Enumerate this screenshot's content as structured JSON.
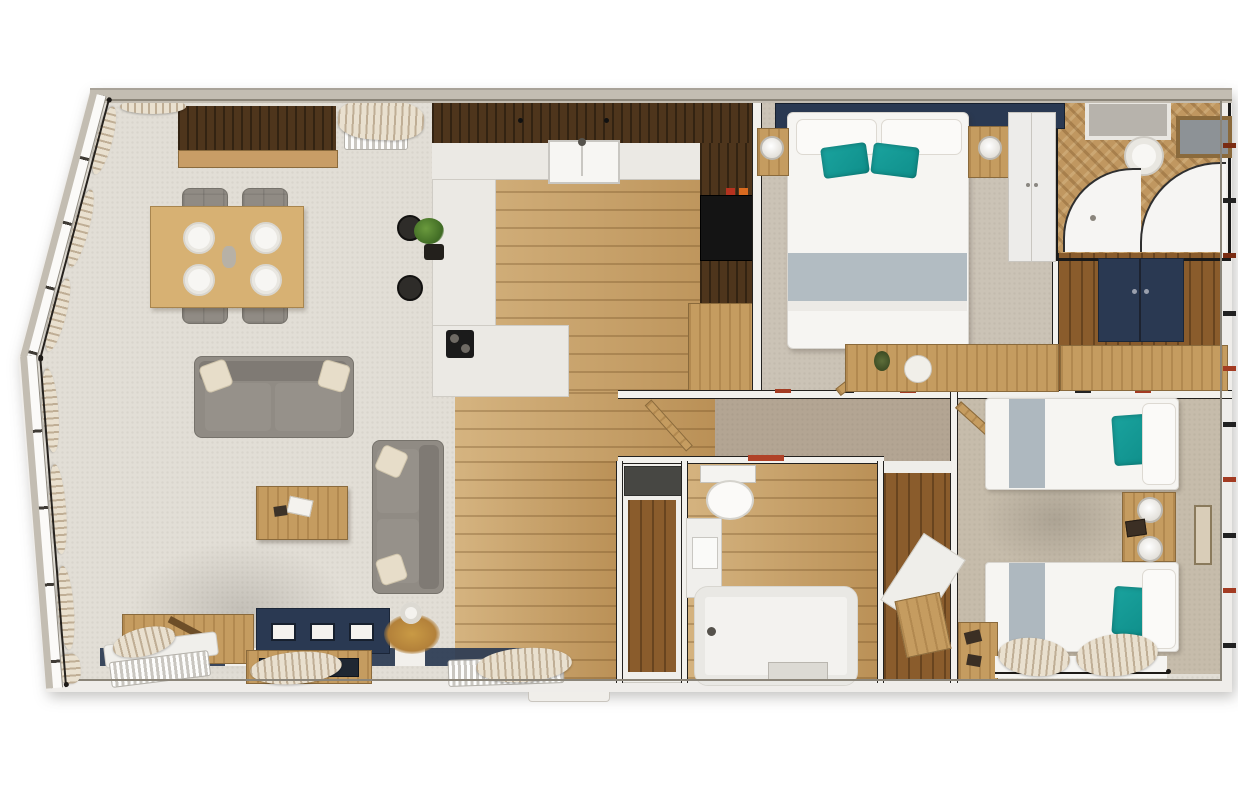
{
  "scene": {
    "type": "floor-plan",
    "style": "photoreal-top-down-3d-render",
    "background": "#ffffff",
    "palette": {
      "wallOuter": "#c3bdb2",
      "wallFace": "#efedea",
      "lineDark": "#23211e",
      "carpetLiving": "#e2ded6",
      "carpetBed": "#cbc3b6",
      "carpetTwin": "#c6bcab",
      "carpetHall": "#b3a593",
      "woodLight": "#c79e63",
      "woodMid": "#b5854c",
      "woodDark": "#4e351c",
      "woodFloorDark": "#8a5c2c",
      "oakFurn": "#c59c60",
      "navy": "#2a3952",
      "teal": "#0f8f8b",
      "cream": "#e9e0cf",
      "sofa": "#908b84",
      "runnerGray": "#aeb8bf",
      "accentRed": "#a33b22",
      "applianceBlack": "#141414"
    },
    "rooms": [
      {
        "name": "living-dining",
        "floor": "cream-carpet",
        "furniture": [
          "sideboard",
          "radiator",
          "dining-table-4-settings",
          "dining-chairs-4",
          "sofa-2-seater-top",
          "sofa-2-seater-side",
          "coffee-table",
          "storage-bench-x",
          "tv-media-wall-navy",
          "fireplace-unit",
          "gold-plant",
          "window-curtains",
          "radiators-2"
        ]
      },
      {
        "name": "kitchen",
        "floor": "oak-planks",
        "furniture": [
          "wall-cabinet-run",
          "counter-with-sink",
          "l-shaped-breakfast-bar",
          "bar-stools-2",
          "bar-plant",
          "cooktop",
          "tall-black-appliance",
          "lower-oak-cabinet",
          "spice-jars-2"
        ]
      },
      {
        "name": "entrance-hall",
        "floor": "oak-planks",
        "furniture": [
          "entrance-door-threshold",
          "open-door-leaf",
          "airing-cupboard"
        ]
      },
      {
        "name": "inner-hall",
        "floor": "taupe-carpet",
        "furniture": []
      },
      {
        "name": "master-bedroom",
        "floor": "beige-carpet",
        "furniture": [
          "navy-headboard",
          "double-bed",
          "white-pillows-2",
          "teal-cushions-2",
          "grey-bed-runner",
          "bedside-table-left",
          "bedside-table-right",
          "round-lamps-2",
          "white-wardrobe",
          "dressing-table-with-decor"
        ]
      },
      {
        "name": "ensuite",
        "floor": "herringbone-oak",
        "furniture": [
          "skylight",
          "round-basin",
          "wood-framed-mirror",
          "curved-corner-shower"
        ]
      },
      {
        "name": "walk-in-dressing",
        "floor": "dark-oak",
        "furniture": [
          "navy-cabinet",
          "oak-surround"
        ]
      },
      {
        "name": "family-bathroom",
        "floor": "oak-planks",
        "furniture": [
          "toilet",
          "vanity-basin",
          "bathtub",
          "bath-mat",
          "red-towel"
        ]
      },
      {
        "name": "walk-in-wardrobe",
        "floor": "dark-oak",
        "furniture": [
          "white-shelving",
          "oak-shelf"
        ]
      },
      {
        "name": "twin-bedroom",
        "floor": "beige-carpet",
        "furniture": [
          "single-bed-top",
          "single-bed-bottom",
          "teal-cushions-2",
          "white-pillows-2",
          "grey-bed-runners-2",
          "shared-bedside-table",
          "round-lamps-2",
          "photo-frame",
          "wall-art",
          "corner-desk",
          "window-curtains"
        ]
      }
    ],
    "bed_count": {
      "double": 1,
      "single": 2
    },
    "accent_cushion_count": 4,
    "dining_place_settings": 4
  }
}
